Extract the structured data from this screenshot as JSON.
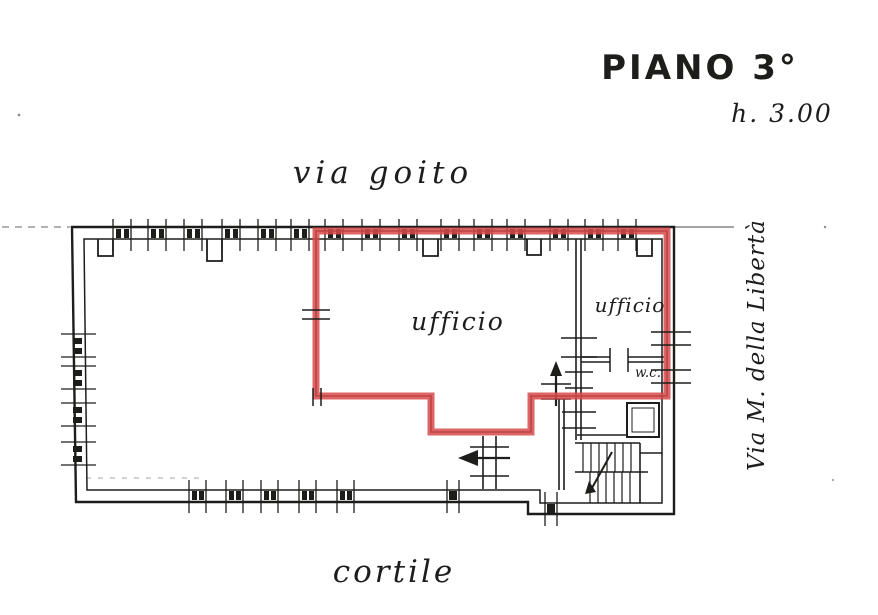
{
  "colors": {
    "ink": "#1d1d1b",
    "highlight": "#d84a4a",
    "paper": "#ffffff"
  },
  "labels": {
    "floor": "PIANO 3°",
    "height": "h. 3.00",
    "street_top": "via goito",
    "street_right": "Via M. della Libertà",
    "courtyard": "cortile"
  },
  "rooms": {
    "office_main": "ufficio",
    "office_small": "ufficio",
    "wc": "w.c."
  }
}
